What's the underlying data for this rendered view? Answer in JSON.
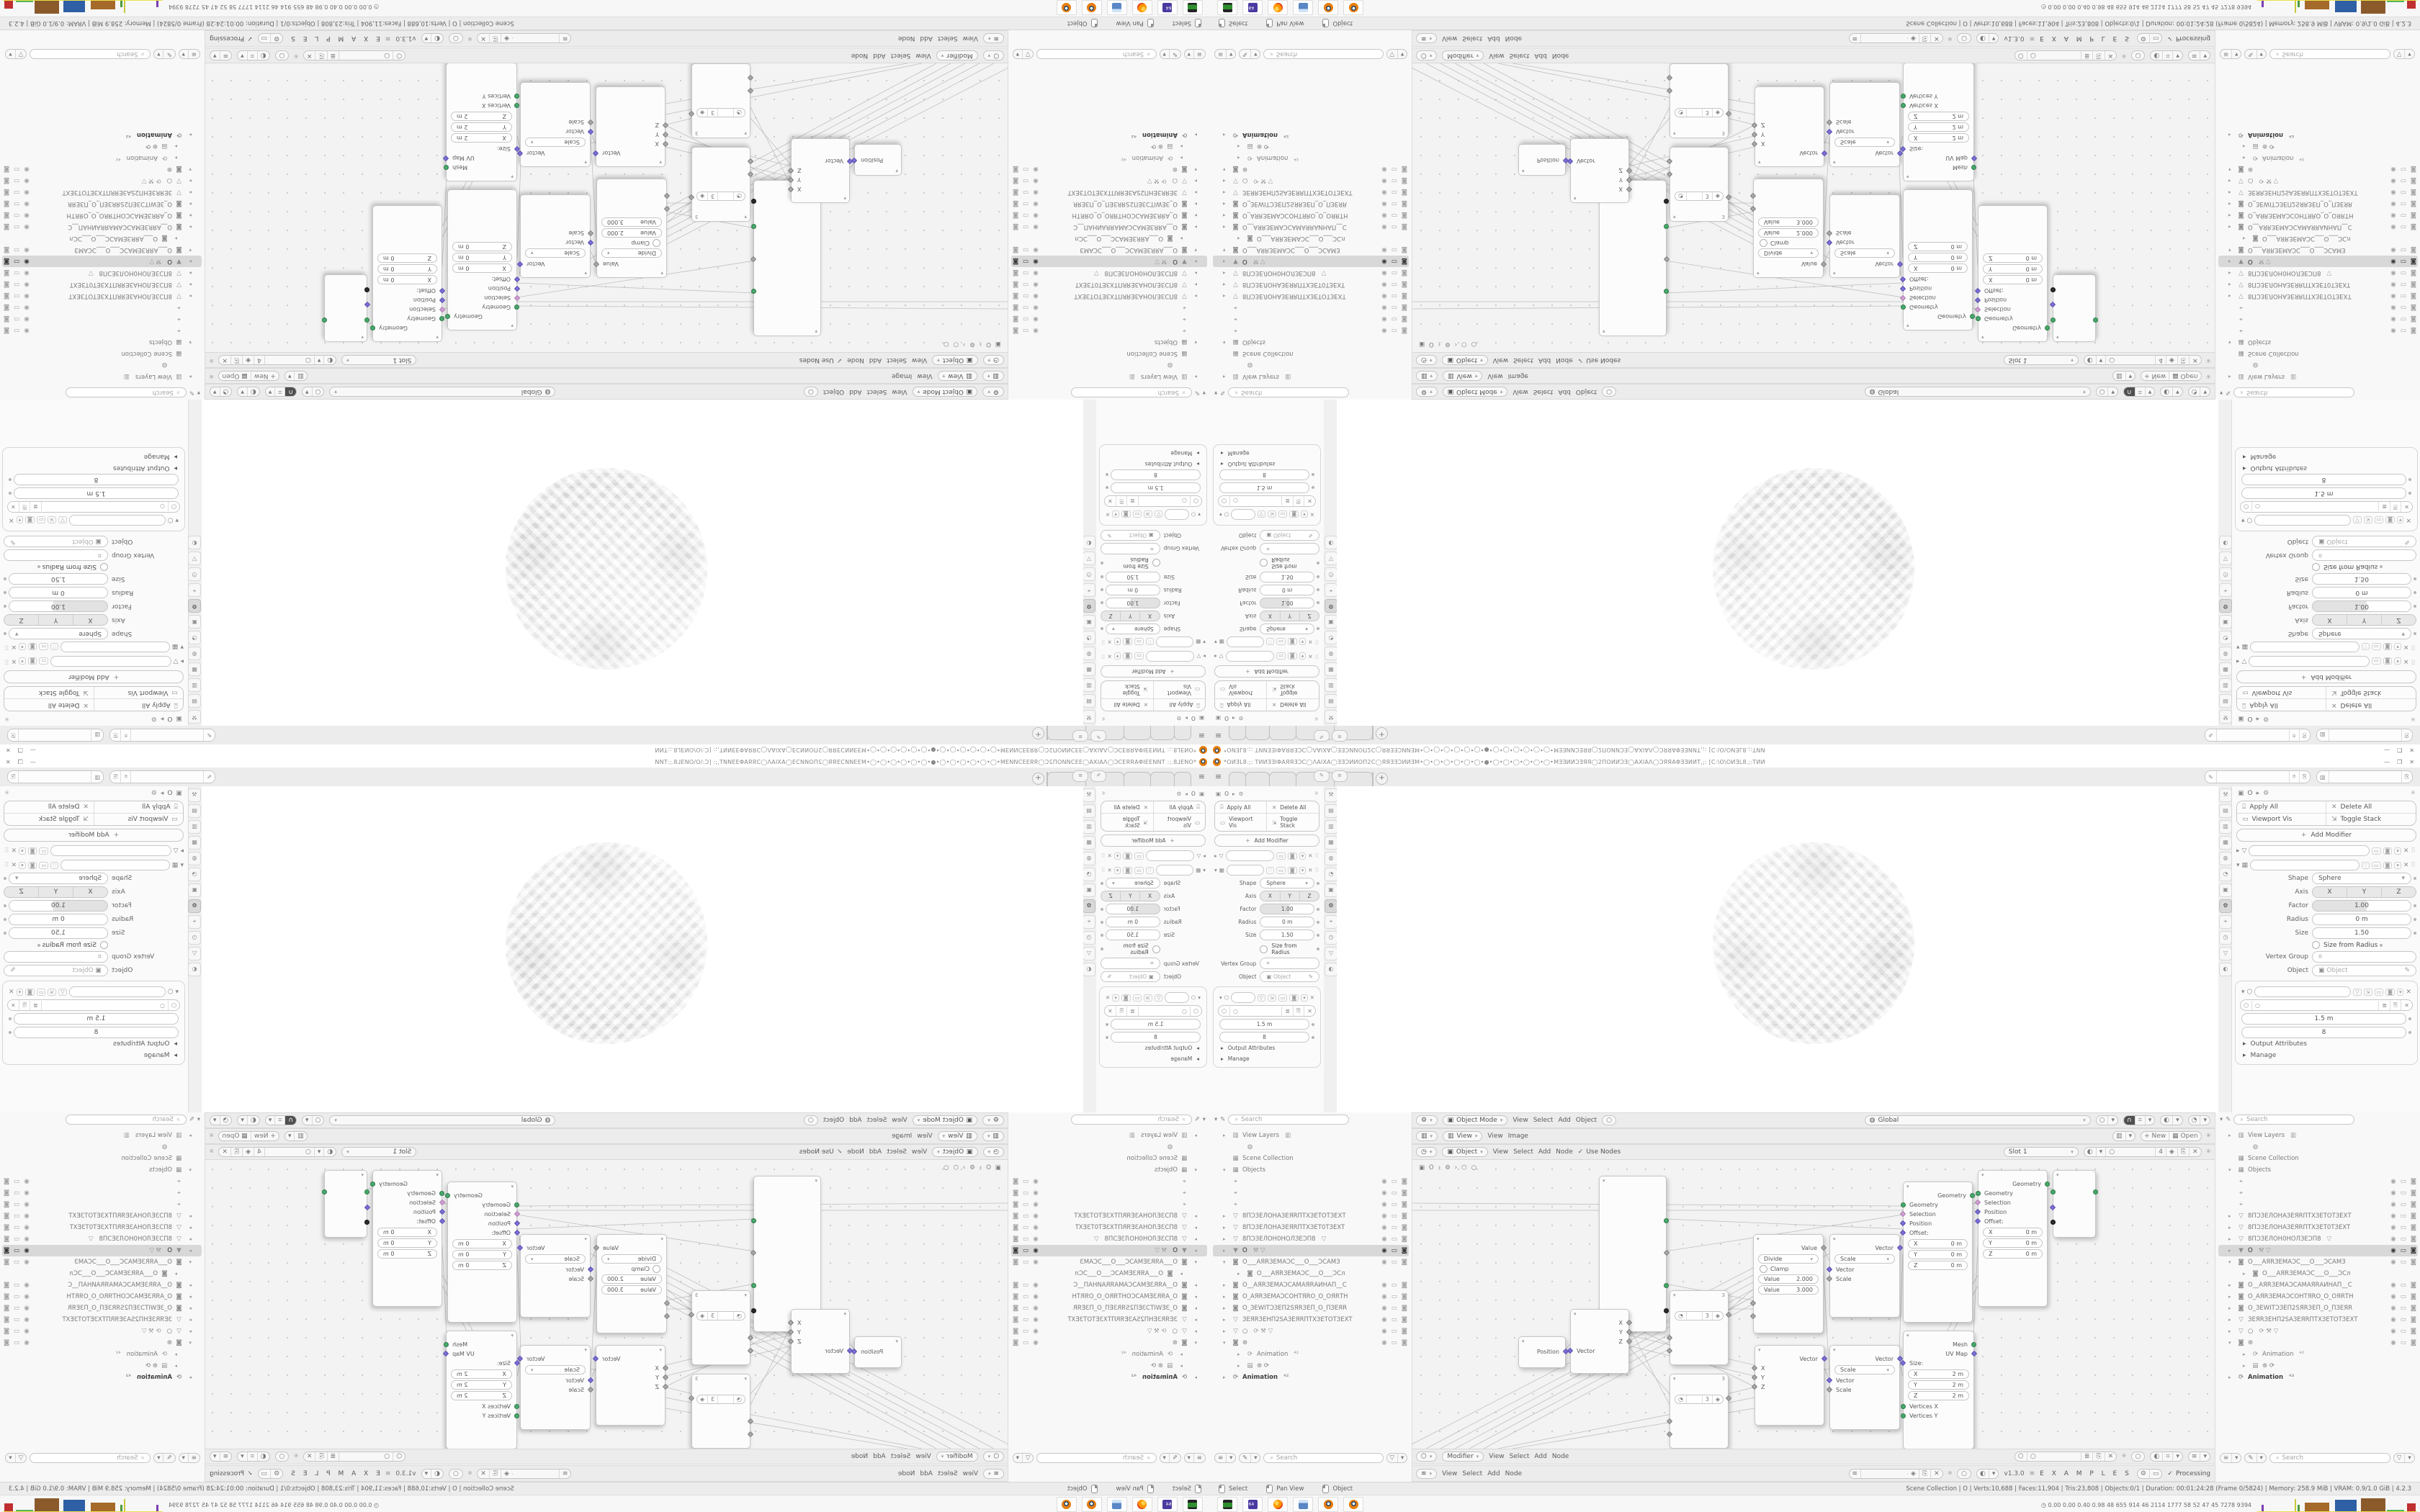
{
  "window": {
    "title": "*ОИƎL8.;: ТИИƎƎІΦАЯЯƎƆϹ◯ΛАІХА◯ƎƎƆИИОП2Ϲ◯ЯЯƎƎƆИИƎМ•◯•◯•◯•◯•◯•◯•●•◯•◯•◯•◯•◯•◯•МƎƎИИƆƎЯЯ◯2ПОИИƆƎ◯АХІАΛ◯ƆЯЯАΦƎƎИИТ,;: [Ϲ:\\О\\ОИƎL8.;:ТИИ",
    "minimize": "—",
    "maximize": "❐",
    "close": "✕"
  },
  "icons": {
    "hamburger": "≡",
    "plus": "+",
    "chev_down": "▾",
    "chev_right": "▸",
    "check": "✓",
    "search": "⌕",
    "pin": "⍟",
    "copy": "⎘",
    "filter": "▽",
    "close": "✕",
    "eye": "◉",
    "screen": "▭",
    "camera": "◙",
    "gear": "⚙",
    "dots": "⠿",
    "circle": "○",
    "dot": "•",
    "apply": "⍗",
    "monitor": "▭",
    "expand": "⇲",
    "brush": "✎",
    "image": "▥",
    "world": "◍",
    "box": "▦",
    "mesh": "▽",
    "object": "▣",
    "anim": "⟳",
    "magnet": "∩",
    "overlay": "◐",
    "grid": "⌗",
    "slider": "≡",
    "mouse": "🖱",
    "graph": "≣",
    "shield": "◈",
    "dna": "≋",
    "tool": "⚒",
    "clock": "◷",
    "node": "⬡",
    "person": "◔",
    "axis": "⌖",
    "film": "▤"
  },
  "tabs": {
    "items": [
      {
        "label": ""
      },
      {
        "label": ""
      },
      {
        "label": ""
      },
      {
        "label": ""
      },
      {
        "label": ""
      },
      {
        "label": ""
      }
    ]
  },
  "props_instances": [
    {
      "cls": "props props-left"
    },
    {
      "cls": "props props-right"
    }
  ],
  "tabstrip_instances": [
    {
      "cls": "tabstrip ts-left"
    },
    {
      "cls": "tabstrip ts-right"
    }
  ],
  "props_tabs": [
    {
      "g": "⚒",
      "cls": "tsi"
    },
    {
      "g": "▤",
      "cls": "tsi"
    },
    {
      "g": "▥",
      "cls": "tsi"
    },
    {
      "g": "▦",
      "cls": "tsi"
    },
    {
      "g": "◍",
      "cls": "tsi"
    },
    {
      "g": "◔",
      "cls": "tsi"
    },
    {
      "g": "▣",
      "cls": "tsi"
    },
    {
      "g": "⚙",
      "cls": "tsi active"
    },
    {
      "g": "⌖",
      "cls": "tsi"
    },
    {
      "g": "◷",
      "cls": "tsi"
    },
    {
      "g": "▽",
      "cls": "tsi"
    },
    {
      "g": "◐",
      "cls": "tsi"
    }
  ],
  "properties": {
    "breadcrumb_object": "O",
    "apply_all": "Apply All",
    "delete_all": "Delete All",
    "viewport_vis": "Viewport Vis",
    "toggle_stack": "Toggle Stack",
    "add_modifier": "Add Modifier",
    "shape_label": "Shape",
    "shape_value": "Sphere",
    "axis_label": "Axis",
    "axis_x": "X",
    "axis_y": "Y",
    "axis_z": "Z",
    "factor_label": "Factor",
    "factor_value": "1.00",
    "radius_label": "Radius",
    "radius_value": "0 m",
    "size_label": "Size",
    "size_value": "1.50",
    "size_from_radius": "Size from Radius",
    "vertex_group_label": "Vertex Group",
    "object_label": "Object",
    "object_placeholder": "Object",
    "nodes_value1": "1.5 m",
    "nodes_value2": "8",
    "output_attributes": "Output Attributes",
    "manage": "Manage"
  },
  "viewport_header": {
    "mode": "Object Mode",
    "m1": "View",
    "m2": "Select",
    "m3": "Add",
    "m4": "Object",
    "orientation": "Global"
  },
  "image_header": {
    "mode": "View",
    "m1": "View",
    "m2": "Image",
    "new_label": "New",
    "open_label": "Open"
  },
  "texture_header": {
    "mode": "Object",
    "m1": "View",
    "m2": "Select",
    "m3": "Add",
    "m4": "Node",
    "use_nodes": "Use Nodes",
    "slot": "Slot 1",
    "count": "4"
  },
  "node_footer1": {
    "mode": "Modifier",
    "m1": "View",
    "m2": "Select",
    "m3": "Add",
    "m4": "Node"
  },
  "node_footer2": {
    "m1": "View",
    "m2": "Select",
    "m3": "Add",
    "m4": "Node",
    "version": "v1.3.0",
    "examples": "E X A M P L E S",
    "processing": "Processing"
  },
  "node_editor": {
    "crumb_object": "O",
    "crumb_sep": "›",
    "nodes": {
      "position": {
        "out": "Position"
      },
      "separate": {
        "in": "Vector",
        "o1": "X",
        "o2": "Y",
        "o3": "Z"
      },
      "objinfo": {
        "count": "3"
      },
      "divide": {
        "out": "Value",
        "op": "Divide",
        "clamp": "Clamp",
        "v1k": "Value",
        "v1": "2.000",
        "v2k": "Value",
        "v2": "3.000"
      },
      "vecscale": {
        "out": "Vector",
        "op": "Scale",
        "in1": "Vector",
        "in2": "Scale"
      },
      "setpos": {
        "out": "Geometry",
        "in1": "Geometry",
        "in2": "Selection",
        "in3": "Position",
        "in4": "Offset:",
        "ax": "X",
        "ay": "Y",
        "az": "Z",
        "zero": "0 m"
      },
      "combine": {
        "out": "Vector",
        "i1": "X",
        "i2": "Y",
        "i3": "Z"
      },
      "cube": {
        "out1": "Mesh",
        "out2": "UV Map",
        "size_label": "Size:",
        "ax": "X",
        "ay": "Y",
        "az": "Z",
        "two": "2 m",
        "v1": "Vertices X",
        "v2": "Vertices Y",
        "v3": "Vertices Z"
      }
    }
  },
  "outliner_instances": [
    {
      "cls": "outl outl-left"
    },
    {
      "cls": "outl outl-right"
    }
  ],
  "outliner": {
    "search_placeholder": "Search",
    "items": [
      {
        "cls": "oi",
        "a": "▸",
        "i": "▥",
        "t": "View Layers",
        "x": "▥",
        "e": "",
        "s": "",
        "c": ""
      },
      {
        "cls": "oi ind2",
        "a": "",
        "i": "◍",
        "t": "",
        "x": "",
        "e": "",
        "s": "",
        "c": ""
      },
      {
        "cls": "oi",
        "a": "",
        "i": "▦",
        "t": "Scene Collection",
        "x": "",
        "e": "",
        "s": "",
        "c": ""
      },
      {
        "cls": "oi",
        "a": "▾",
        "i": "▦",
        "t": "Objects",
        "x": "",
        "e": "",
        "s": "",
        "c": ""
      },
      {
        "cls": "oi",
        "a": "",
        "i": "⌖",
        "t": "",
        "x": "",
        "e": "◉",
        "s": "▭",
        "c": "◙"
      },
      {
        "cls": "oi",
        "a": "",
        "i": "⌖",
        "t": "",
        "x": "",
        "e": "◉",
        "s": "▭",
        "c": "◙"
      },
      {
        "cls": "oi",
        "a": "",
        "i": "⌖",
        "t": "",
        "x": "",
        "e": "◉",
        "s": "▭",
        "c": "◙"
      },
      {
        "cls": "oi",
        "a": "▸",
        "i": "▽",
        "t": "8ПƆЗЕЛОНАЗЕЯRПТХЗЕТОТЗЕХТ",
        "x": "",
        "e": "◉",
        "s": "▭",
        "c": "◙"
      },
      {
        "cls": "oi",
        "a": "▸",
        "i": "▽",
        "t": "8ПƆЗЕЛОНАЗЕЯRПТХЗЕТ0ТЗЕХТ",
        "x": "",
        "e": "◉",
        "s": "▭",
        "c": "◙"
      },
      {
        "cls": "oi",
        "a": "▸",
        "i": "▽",
        "t": "8ПƆЗЕЛОН0НОЛЗЕƆП8",
        "x": "▽",
        "e": "◉",
        "s": "▭",
        "c": "◙"
      },
      {
        "cls": "oi sel",
        "a": "▸",
        "i": "▼",
        "t": "O",
        "x": "⚒ ▽",
        "e": "◉",
        "s": "▭",
        "c": "◙"
      },
      {
        "cls": "oi",
        "a": "▾",
        "i": "◙",
        "t": "O___АЯRЗЕМАƆС___О___ƆСАМЗ",
        "x": "",
        "e": "◉",
        "s": "▭",
        "c": "◙"
      },
      {
        "cls": "oi ind2",
        "a": "▸",
        "i": "◙",
        "t": "O___АЯRЗЕМАƆС___О___ƆСл",
        "x": "",
        "e": "",
        "s": "",
        "c": ""
      },
      {
        "cls": "oi",
        "a": "▸",
        "i": "◙",
        "t": "O__АЯRЗЕМАƆСАМАЯRАИНАП__С",
        "x": "",
        "e": "◉",
        "s": "▭",
        "c": "◙"
      },
      {
        "cls": "oi",
        "a": "▸",
        "i": "◙",
        "t": "O_АЯRЗЕМАƆСОНТЯRО_О_ОЯRТН",
        "x": "",
        "e": "◉",
        "s": "▭",
        "c": "◙"
      },
      {
        "cls": "oi",
        "a": "▸",
        "i": "◙",
        "t": "O_ЗЕWІТƆЗЕП2SЯRЗЕП_О_ПЗЕЯR",
        "x": "",
        "e": "◉",
        "s": "▭",
        "c": "◙"
      },
      {
        "cls": "oi",
        "a": "▸",
        "i": "▽",
        "t": "ЗЕЯRЗЕНП2SАЗЕЯRПТХЗЕТОТЗЕХТ",
        "x": "",
        "e": "◉",
        "s": "▭",
        "c": "◙"
      },
      {
        "cls": "oi",
        "a": "▸",
        "i": "▽",
        "t": "○",
        "x": "⟳ ⚒ ▽",
        "e": "◉",
        "s": "▭",
        "c": "◙"
      },
      {
        "cls": "oi",
        "a": "▾",
        "i": "◙",
        "t": "⊛",
        "x": "",
        "e": "◉",
        "s": "▭",
        "c": "◙"
      },
      {
        "cls": "oi ind2",
        "a": "▸",
        "i": "⟳",
        "t": "Animation",
        "x": "⁴²",
        "e": "",
        "s": "",
        "c": ""
      },
      {
        "cls": "oi ind2",
        "a": "▸",
        "i": "▤",
        "t": "⊛ ⟳",
        "x": "",
        "e": "",
        "s": "",
        "c": ""
      },
      {
        "cls": "oi strong",
        "a": "▸",
        "i": "⟳",
        "t": "Animation",
        "x": "⁴²",
        "e": "",
        "s": "",
        "c": ""
      }
    ]
  },
  "status_bar": {
    "hint1": "Select",
    "hint2": "Pan View",
    "hint3": "Object",
    "stats": "Scene Collection | O | Verts:10,688 | Faces:11,904 | Tris:23,808 | Objects:0/1 | Duration: 00:01:24:28 (Frame 0/5824) | Memory: 258.9 MiB | VRAM: 0.9/1.0 GiB | 4.2.3"
  },
  "taskbar": {
    "apps": [
      {
        "name": "system-monitor-icon"
      },
      {
        "name": "floppy64-icon"
      },
      {
        "name": "firefox-icon"
      },
      {
        "name": "calculator-icon"
      },
      {
        "name": "blender-icon"
      },
      {
        "name": "blender-icon"
      }
    ],
    "tray_stats": "0.00 0.00 0.40 0.98  48  655 914  46  2114 1777  58  52  47  45  7278 9394",
    "histogram": [
      {
        "style": "left:6px;width:3px;height:9px;background:#7a3fb0"
      },
      {
        "style": "left:52px;width:2px;height:17px;background:#c9c93a"
      },
      {
        "style": "left:56px;width:3px;height:9px;background:#4a9a3a"
      },
      {
        "style": "left:66px;width:34px;height:12px;background:#a5692a"
      },
      {
        "style": "left:108px;width:30px;height:16px;background:#2f5fa5"
      },
      {
        "style": "left:144px;width:34px;height:18px;background:#8a5a2b"
      },
      {
        "style": "left:180px;width:24px;height:2px;background:#57b357"
      },
      {
        "style": "left:208px;width:12px;height:11px;background:#c03030"
      }
    ]
  },
  "colors": {
    "accent_orange": "#e87d0d",
    "socket_green": "#47a96b",
    "socket_purple": "#7a6fd4",
    "socket_pink": "#d2a0d6",
    "selection_gray": "#d8d8d8",
    "baseline_yellow": "#e8e24a"
  }
}
